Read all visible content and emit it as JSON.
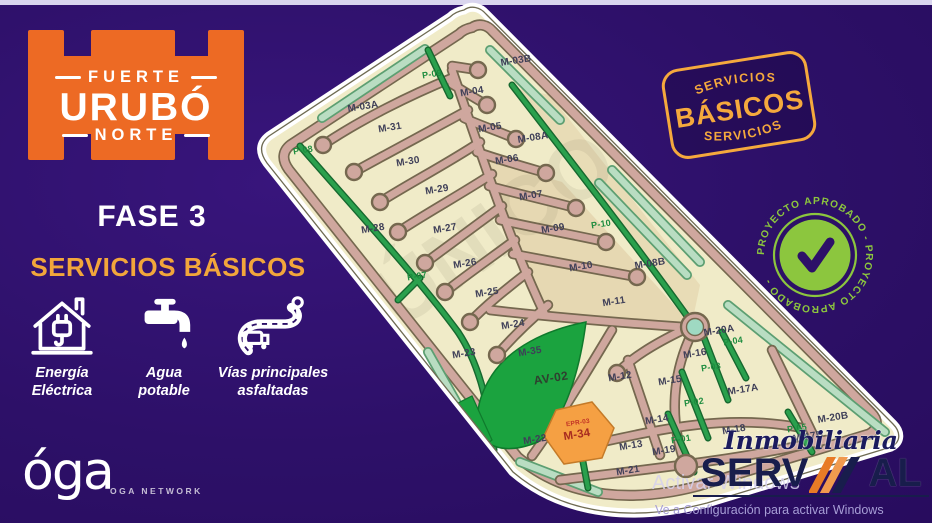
{
  "page": {
    "background": "#2d1068",
    "topbar_color": "#d9d5ee"
  },
  "brand": {
    "top": "FUERTE",
    "middle": "URUBÓ",
    "bottom": "NORTE",
    "phase": "FASE 3",
    "color": "#ed6a24"
  },
  "services": {
    "title": "SERVICIOS BÁSICOS",
    "title_color": "#f2a63b",
    "items": [
      {
        "icon": "house-electricity-icon",
        "line1": "Energía",
        "line2": "Eléctrica"
      },
      {
        "icon": "water-tap-icon",
        "line1": "Agua",
        "line2": "potable"
      },
      {
        "icon": "asphalt-road-icon",
        "line1": "Vías principales",
        "line2": "asfaltadas"
      }
    ]
  },
  "network": {
    "logo": "óga",
    "caption": "OGA NETWORK"
  },
  "badge": {
    "top": "SERVICIOS",
    "main": "BÁSICOS",
    "bottom": "SERVICIOS",
    "color": "#f5a93d"
  },
  "stamp": {
    "ring_text": "PROYECTO APROBADO - PROYECTO APROBADO -",
    "color": "#8cc63e"
  },
  "developer": {
    "prefix": "Inmobiliaria",
    "name": "SERVIMAL",
    "name_left": "SERV",
    "name_right": "AL"
  },
  "system_watermark": {
    "line1": "Activar Windows",
    "line2": "Ve a Configuración para activar Windows"
  },
  "map": {
    "colors": {
      "ground": "#f0ebc8",
      "road": "#cfa79e",
      "green_road": "#2aa04d",
      "park_area": "#1ba33f",
      "highlight_lot": "#f5a043"
    },
    "labels": [
      {
        "id": "M-03B",
        "x": 516,
        "y": 61,
        "type": "lot"
      },
      {
        "id": "M-03A",
        "x": 363,
        "y": 107,
        "type": "lot"
      },
      {
        "id": "M-04",
        "x": 472,
        "y": 92,
        "type": "lot"
      },
      {
        "id": "M-31",
        "x": 390,
        "y": 128,
        "type": "lot"
      },
      {
        "id": "M-05",
        "x": 490,
        "y": 128,
        "type": "lot"
      },
      {
        "id": "M-08A",
        "x": 533,
        "y": 138,
        "type": "lot"
      },
      {
        "id": "M-30",
        "x": 408,
        "y": 162,
        "type": "lot"
      },
      {
        "id": "M-06",
        "x": 507,
        "y": 160,
        "type": "lot"
      },
      {
        "id": "M-29",
        "x": 437,
        "y": 190,
        "type": "lot"
      },
      {
        "id": "M-07",
        "x": 531,
        "y": 196,
        "type": "lot"
      },
      {
        "id": "M-28",
        "x": 373,
        "y": 229,
        "type": "lot"
      },
      {
        "id": "M-27",
        "x": 445,
        "y": 229,
        "type": "lot"
      },
      {
        "id": "M-09",
        "x": 553,
        "y": 229,
        "type": "lot"
      },
      {
        "id": "M-26",
        "x": 465,
        "y": 264,
        "type": "lot"
      },
      {
        "id": "M-08B",
        "x": 650,
        "y": 264,
        "type": "lot"
      },
      {
        "id": "M-10",
        "x": 581,
        "y": 267,
        "type": "lot"
      },
      {
        "id": "M-25",
        "x": 487,
        "y": 293,
        "type": "lot"
      },
      {
        "id": "M-11",
        "x": 614,
        "y": 302,
        "type": "lot"
      },
      {
        "id": "M-24",
        "x": 513,
        "y": 325,
        "type": "lot"
      },
      {
        "id": "M-20A",
        "x": 719,
        "y": 331,
        "type": "lot"
      },
      {
        "id": "M-35",
        "x": 530,
        "y": 352,
        "type": "lot"
      },
      {
        "id": "M-23",
        "x": 464,
        "y": 354,
        "type": "lot"
      },
      {
        "id": "M-16",
        "x": 695,
        "y": 354,
        "type": "lot"
      },
      {
        "id": "M-12",
        "x": 620,
        "y": 377,
        "type": "lot"
      },
      {
        "id": "M-15",
        "x": 670,
        "y": 381,
        "type": "lot"
      },
      {
        "id": "M-17A",
        "x": 743,
        "y": 390,
        "type": "lot"
      },
      {
        "id": "M-20B",
        "x": 833,
        "y": 418,
        "type": "lot"
      },
      {
        "id": "M-14",
        "x": 657,
        "y": 420,
        "type": "lot"
      },
      {
        "id": "M-18",
        "x": 734,
        "y": 430,
        "type": "lot"
      },
      {
        "id": "M-17B",
        "x": 808,
        "y": 437,
        "type": "lot"
      },
      {
        "id": "M-22",
        "x": 535,
        "y": 440,
        "type": "lot"
      },
      {
        "id": "M-13",
        "x": 631,
        "y": 446,
        "type": "lot"
      },
      {
        "id": "M-19",
        "x": 664,
        "y": 451,
        "type": "lot"
      },
      {
        "id": "M-21",
        "x": 628,
        "y": 471,
        "type": "lot"
      },
      {
        "id": "P-09",
        "x": 432,
        "y": 74,
        "type": "park"
      },
      {
        "id": "P-08",
        "x": 303,
        "y": 150,
        "type": "park"
      },
      {
        "id": "P-10",
        "x": 601,
        "y": 224,
        "type": "park"
      },
      {
        "id": "P-07",
        "x": 417,
        "y": 276,
        "type": "park"
      },
      {
        "id": "P-04",
        "x": 733,
        "y": 341,
        "type": "park"
      },
      {
        "id": "P-03",
        "x": 711,
        "y": 367,
        "type": "park"
      },
      {
        "id": "P-02",
        "x": 694,
        "y": 402,
        "type": "park"
      },
      {
        "id": "P-05",
        "x": 797,
        "y": 428,
        "type": "park"
      },
      {
        "id": "P-01",
        "x": 681,
        "y": 439,
        "type": "park"
      },
      {
        "id": "AV-02",
        "x": 551,
        "y": 378,
        "type": "area"
      },
      {
        "id": "EPR-03",
        "x": 578,
        "y": 423,
        "type": "red"
      },
      {
        "id": "M-34",
        "x": 577,
        "y": 435,
        "type": "orange-lot"
      }
    ]
  }
}
